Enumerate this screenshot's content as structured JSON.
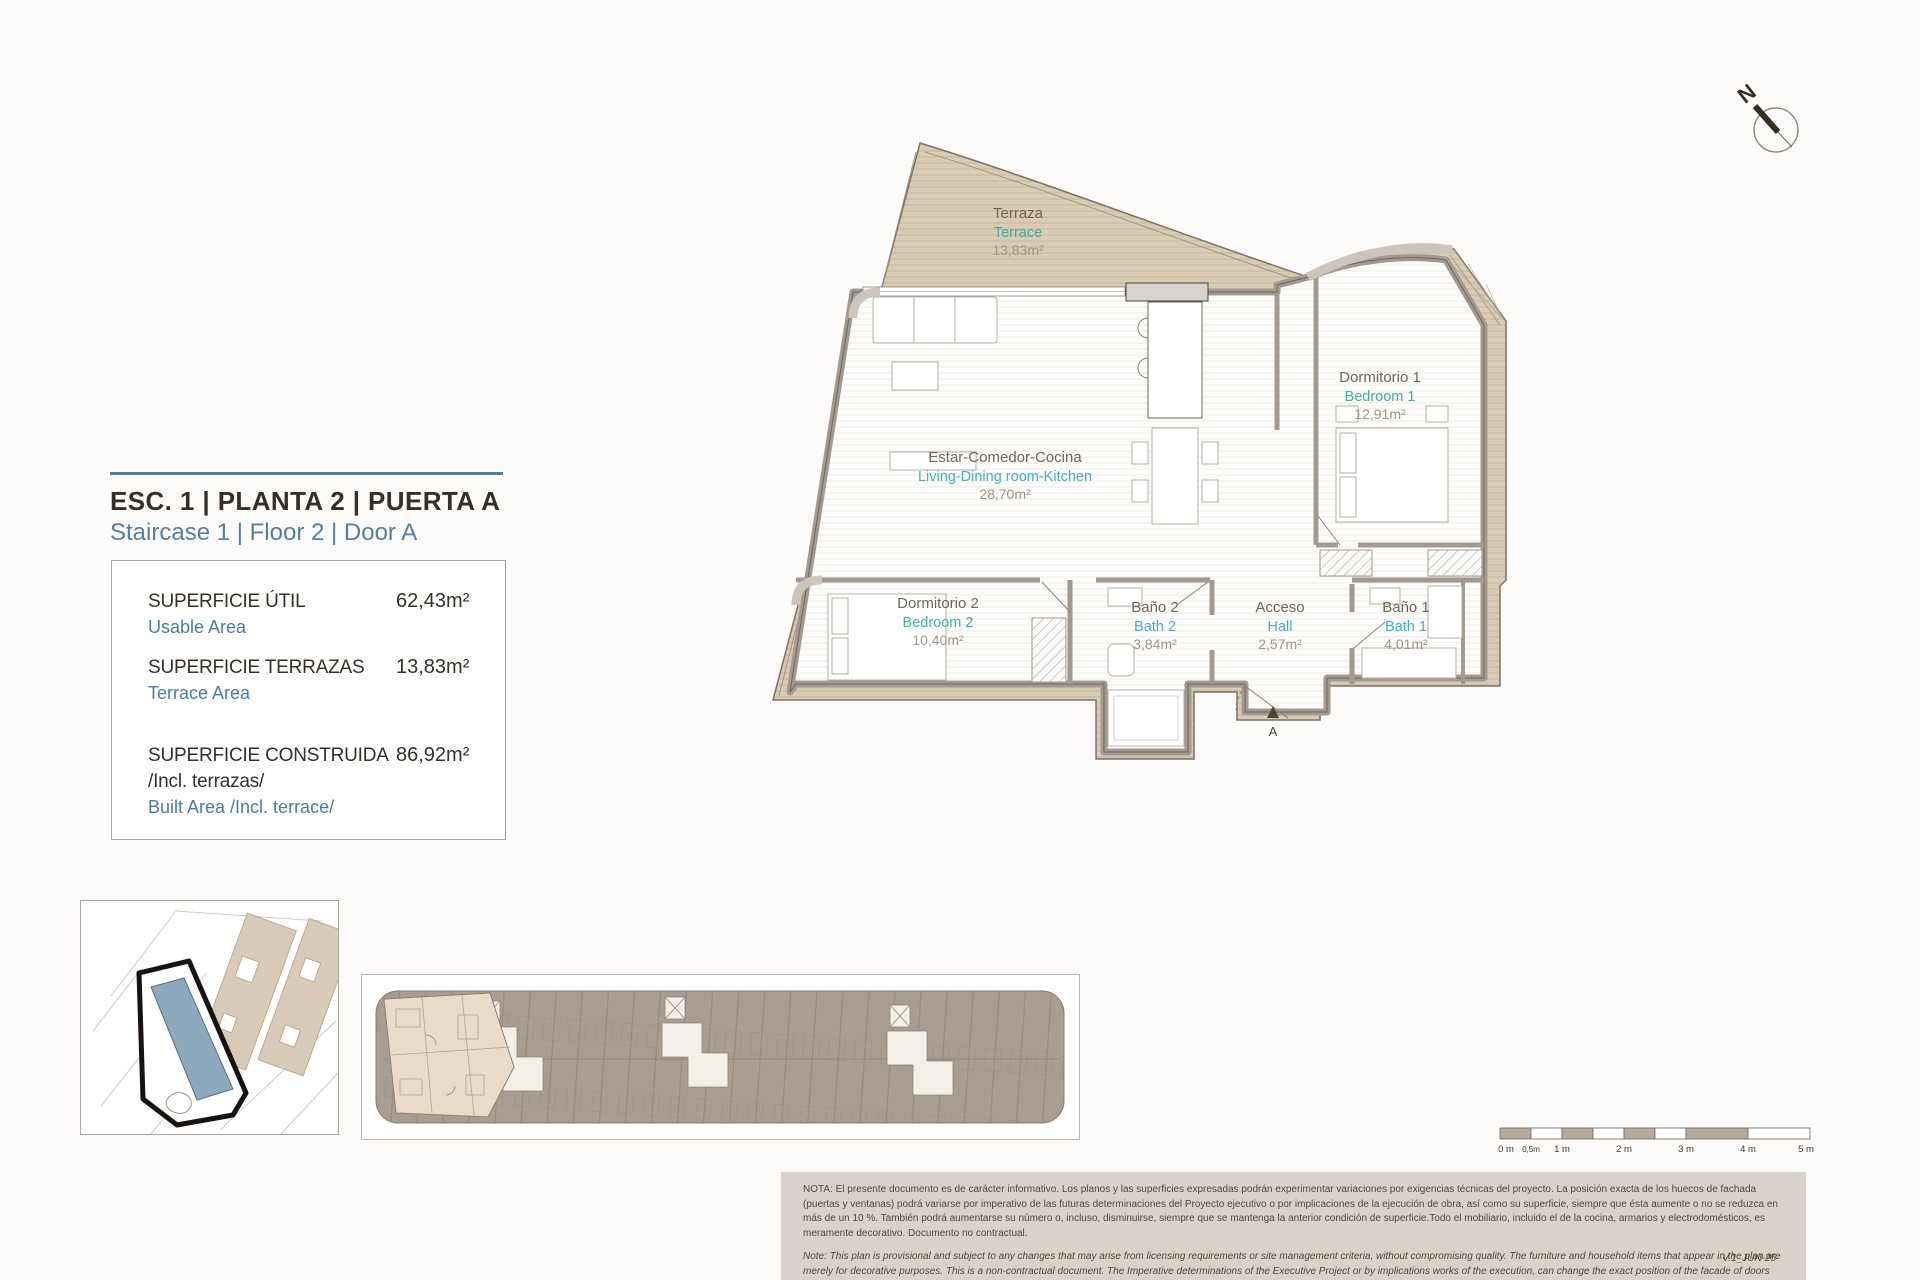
{
  "header": {
    "title_es": "ESC. 1 | PLANTA 2 | PUERTA A",
    "title_en": "Staircase 1 | Floor 2 | Door A"
  },
  "area_table": {
    "rows": [
      {
        "label_es": "SUPERFICIE ÚTIL",
        "label_en": "Usable Area",
        "value": "62,43m²"
      },
      {
        "label_es": "SUPERFICIE TERRAZAS",
        "label_en": "Terrace Area",
        "value": "13,83m²"
      },
      {
        "label_es": "SUPERFICIE CONSTRUIDA",
        "label_es2": "/Incl. terrazas/",
        "label_en": "Built Area /Incl. terrace/",
        "value": "86,92m²"
      }
    ]
  },
  "plan": {
    "terrace": {
      "es": "Terraza",
      "en": "Terrace",
      "area": "13,83m²"
    },
    "living": {
      "es": "Estar-Comedor-Cocina",
      "en": "Living-Dining room-Kitchen",
      "area": "28,70m²"
    },
    "bedroom1": {
      "es": "Dormitorio 1",
      "en": "Bedroom 1",
      "area": "12,91m²"
    },
    "bedroom2": {
      "es": "Dormitorio 2",
      "en": "Bedroom 2",
      "area": "10,40m²"
    },
    "bath2": {
      "es": "Baño 2",
      "en": "Bath 2",
      "area": "3,84m²"
    },
    "hall": {
      "es": "Acceso",
      "en": "Hall",
      "area": "2,57m²"
    },
    "bath1": {
      "es": "Baño 1",
      "en": "Bath 1",
      "area": "4,01m²"
    },
    "entrance": "A"
  },
  "compass": {
    "label": "N"
  },
  "scale": {
    "labels": [
      "0 m",
      "0,5m",
      "1 m",
      "2 m",
      "3 m",
      "4 m",
      "5 m"
    ]
  },
  "notes": {
    "es": "NOTA:  El presente documento es de carácter informativo. Los planos y las superficies expresadas podrán experimentar variaciones por exigencias técnicas del proyecto. La posición exacta de los huecos de fachada (puertas y ventanas) podrá variarse por imperativo de las futuras determinaciones del Proyecto ejecutivo o por implicaciones de la ejecución de obra, así como su superficie, siempre que ésta aumente o no se reduzca en más de un 10 %. También podrá aumentarse su número o, incluso, disminuirse, siempre que se mantenga la anterior condición de superficie.Todo el mobiliario, incluido el de la cocina, armarios y electrodomésticos, es meramente decorativo. Documento no contractual.",
    "en": "Note: This plan is provisional and subject to any changes that may arise from licensing requirements or site management criteria, without compromising quality. The furniture and household items that appear in the plan are merely for decorative purposes. This is a non-contractual document. The Imperative determinations of the Executive Project or by implications works of the execution, can change the exact position of the facade of doors and windows, as well the surface area may also be increased or even decrease not more than a 10%.",
    "version": "V.1_JUN-25"
  },
  "colors": {
    "accent_blue": "#54809f",
    "table_blue": "#4a7ca3",
    "label_teal": "#3fae9f",
    "label_cyan": "#3fb0c8",
    "terrace_fill": "#d9cbb4",
    "wall": "#a29990",
    "notes_panel": "#dad2ca",
    "scale_fill": "#b7aa9c"
  }
}
